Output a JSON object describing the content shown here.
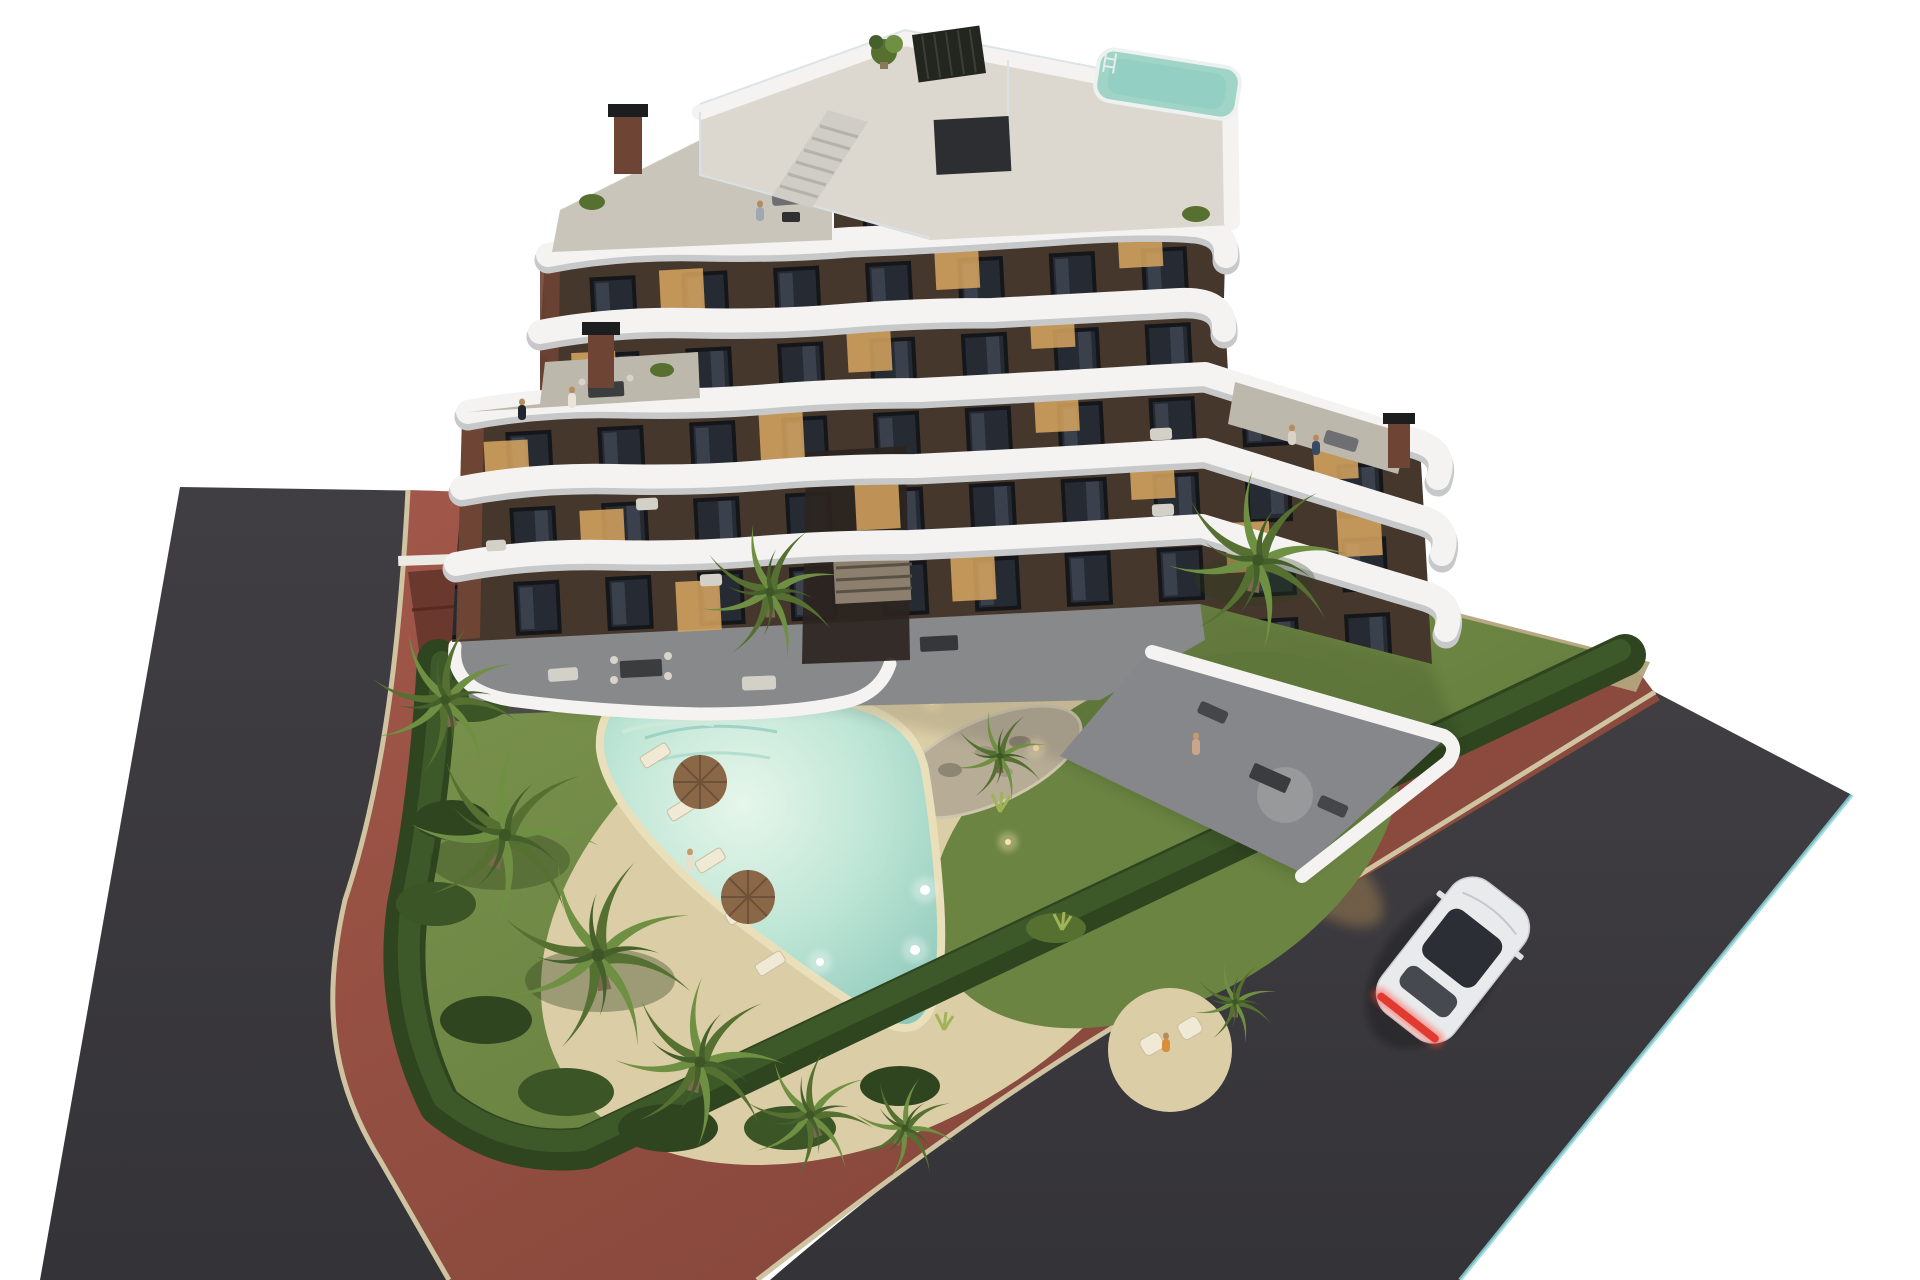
{
  "scene": {
    "view": "aerial dusk render of residential complex on white background",
    "building": {
      "floors_visible": 7,
      "balcony_bands": 5,
      "facade_style": "dark brown with white curved balcony ribbons",
      "rooftop_pool": true,
      "rooftop_pergola": true,
      "rooftop_stairs": true,
      "chimneys_visible": 4,
      "terraces_with_people": 3
    },
    "garden": {
      "lawn": true,
      "hedge_border": true,
      "pool_shape": "organic curved pool with underwater lights",
      "pool_lights": 5,
      "sun_loungers": 5,
      "umbrellas": 2,
      "palm_trees": 10,
      "rock_island": true
    },
    "street": {
      "surface": "dark asphalt corner road",
      "sidewalk": "red brick with beige curbs",
      "car": {
        "color": "white",
        "taillights": "red",
        "heading": "up-right"
      }
    },
    "people_visible": 8
  },
  "colors": {
    "background": "#ffffff",
    "asphalt": "#3e3c40",
    "asphalt_deep": "#343338",
    "brick": "#9a5244",
    "curb": "#cfc3a2",
    "road_edge_teal": "#8fd8dd",
    "shoulder_tan": "#b3a47c",
    "lawn_light": "#7e9650",
    "lawn_dark": "#5a7136",
    "hedge": "#2f451f",
    "hedge_light": "#3f5a2a",
    "sand_deck": "#dbcda5",
    "pool_lip": "#e9dfba",
    "pool_water": "#9fd4c6",
    "pool_bright": "#e6f6ea",
    "facade_brown": "#46372c",
    "facade_shadow": "#2b2420",
    "rust": "#6e4434",
    "band_white": "#f4f3f1",
    "band_shadow": "#c6c8c9",
    "terrace_gray": "#87898b",
    "terrace_light": "#bdb8ac",
    "roof_deck": "#dcd8cf",
    "pergola_black": "#23261f",
    "window_lit": "#d8a660",
    "palm_green": "#6f9042",
    "palm_dark": "#557031",
    "car_body": "#e9eaec",
    "car_glass": "#2b2e35",
    "taillight": "#e23a30",
    "glow_warm": "#e8b05c"
  }
}
